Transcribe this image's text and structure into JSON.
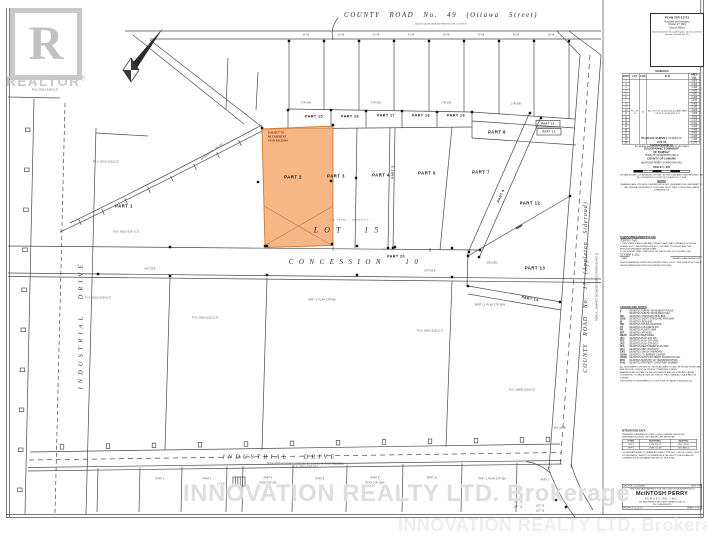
{
  "branding": {
    "logo_letter": "R",
    "logo_caption": "REALTOR",
    "logo_reg": "®",
    "watermark_text": "INNOVATION REALTY LTD.  Brokerage"
  },
  "deposit_box": {
    "plan_no": "PLAN 27R-11751",
    "received": "Received and Deposited",
    "date": "October 27, 2021",
    "signature": "Joanne Milner",
    "representative": "Representative for the Land Registrar for the Land Titles Division of Lanark (No. 27)"
  },
  "schedule": {
    "title": "SCHEDULE",
    "headers": [
      "PART",
      "LOT",
      "CON",
      "P.I.N.",
      "AREA (ha)"
    ],
    "lot": "PT. LOT 15",
    "con": "10",
    "pin": "ALL OF P.I.N. 05110-0114 (LT) AND PART OF P.I.N. 05110-0113 (LT)",
    "parts": [
      "1",
      "2",
      "3",
      "4",
      "5",
      "6",
      "7",
      "8",
      "9",
      "10",
      "11",
      "12",
      "13",
      "14",
      "15",
      "16",
      "17",
      "18",
      "19",
      "20"
    ],
    "areas": [
      "0.809",
      "0.405",
      "0.405",
      "0.405",
      "0.081",
      "0.405",
      "0.810",
      "0.405",
      "0.162",
      "0.008",
      "0.008",
      "1.620",
      "1.215",
      "0.243",
      "0.405",
      "0.405",
      "0.405",
      "0.405",
      "0.405",
      "0.073"
    ],
    "note": "ALL AREAS SHOWN ON THIS PLAN ARE IN HECTARES"
  },
  "title_block": {
    "t1a": "PLAN OF SURVEY",
    "t1b": "OF PART OF",
    "t2": "LOT 15",
    "t3": "CONCESSION 10",
    "t4": "GEOGRAPHIC TOWNSHIP\nOF RAMSAY",
    "t5": "TOWN OF MISSISSIPPI MILLS",
    "t6": "COUNTY OF LANARK",
    "firm": "McINTOSH PERRY SURVEYING INC.",
    "scale": "SCALE  1 : 800",
    "metric": "DISTANCES AND COORDINATES SHOWN ON THIS PLAN ARE IN METRES AND CAN BE CONVERTED TO FEET BY DIVIDING BY 0.3048",
    "notes_title": "NOTES",
    "notes_body": "BEARINGS ARE UTM GRID, DERIVED FROM GPS OBSERVATIONS, REFERRED TO THE CENTRAL MERIDIAN OF UTM ZONE 18 (75° WEST LONGITUDE), NAD83 (CSRS)(2010.0)"
  },
  "certificate": {
    "title": "SURVEYOR'S CERTIFICATE",
    "intro": "I CERTIFY THAT:",
    "c1": "1.  THIS SURVEY AND PLAN ARE CORRECT AND IN ACCORDANCE WITH THE SURVEYS ACT, THE SURVEYORS ACT, THE LAND TITLES ACT AND THE REGULATIONS MADE UNDER THEM.",
    "c2": "2.  THE SURVEY WAS COMPLETED ON THE 8th DAY OF OCTOBER, 2021.",
    "date": "OCTOBER 8, 2021",
    "date_cap": "DATE",
    "signer_cap": "ONTARIO LAND SURVEYOR",
    "note": "PLAN SUBMISSION FORM FILED UNDER O.REG. 216/10. THIS PLAN IS NOT VALID UNLESS EMBOSSED WITH THE SURVEYOR'S SEAL."
  },
  "legend": {
    "title": "LEGEND AND NOTES",
    "items": [
      [
        "■",
        "DENOTES SURVEY MONUMENT FOUND"
      ],
      [
        "□",
        "DENOTES SURVEY MONUMENT SET"
      ],
      [
        "SIB",
        "DENOTES STANDARD IRON BAR"
      ],
      [
        "SSIB",
        "DENOTES SHORT STANDARD IRON BAR"
      ],
      [
        "IB",
        "DENOTES IRON BAR"
      ],
      [
        "RIB",
        "DENOTES ROUND IRON BAR"
      ],
      [
        "CP",
        "DENOTES CONCRETE PIN"
      ],
      [
        "PB",
        "DENOTES PLASTIC BAR"
      ],
      [
        "WIT",
        "DENOTES WITNESS"
      ],
      [
        "MEAS",
        "DENOTES MEASURED"
      ],
      [
        "(P1)",
        "DENOTES PLAN 27R-306"
      ],
      [
        "(P2)",
        "DENOTES PLAN 27R-1606"
      ],
      [
        "(P3)",
        "DENOTES PLAN 27R-3421"
      ],
      [
        "(P4)",
        "DENOTES REGISTERED PLAN 6262"
      ],
      [
        "(D1)",
        "DENOTES INST. RS175478"
      ],
      [
        "(OU)",
        "DENOTES ORIGIN UNKNOWN"
      ],
      [
        "(1306)",
        "DENOTES J.D. BARNES LIMITED"
      ],
      [
        "(1606)",
        "DENOTES McINTOSH PERRY SURVEYING INC."
      ],
      [
        "MTO",
        "DENOTES MINISTRY OF TRANSPORTATION"
      ],
      [
        "P.I.N.",
        "DENOTES PROPERTY IDENTIFIER NUMBER"
      ]
    ],
    "footnotes": [
      "ALL MONUMENTS SHOWN ON THIS PLAN WERE FOUND OR SET AS NOTED AND ARE IN GOOD CONDITION UNLESS OTHERWISE STATED.",
      "BEARINGS AND DISTANCES SHOWN HEREON ARE GROUND AND CAN BE CONVERTED TO GRID BY MULTIPLYING BY THE COMBINED SCALE FACTOR 0.999890.",
      "THIS SURVEY IS INTEGRATED TO UTM ZONE 18, NAD83 (CSRS)(2010.0)."
    ]
  },
  "integration": {
    "title": "INTEGRATION DATA",
    "l1": "OBSERVED REFERENCE POINTS (ORPs) DERIVED FROM GPS OBSERVATION USING THE CAN-NET VRS NETWORK.",
    "headers": [
      "POINT",
      "NORTHING",
      "EASTING"
    ],
    "rows": [
      [
        "ORP 1",
        "4 998 476.11",
        "369 724.60"
      ],
      [
        "ORP 2",
        "4 998 212.48",
        "369 488.02"
      ]
    ],
    "l2": "COORDINATES ARE TO URBAN ACCURACY PER SEC. 14(2) OF O.REG. 216/10",
    "note": "COORDINATES CANNOT, IN THEMSELVES, BE USED TO RE-ESTABLISH CORNERS OR BOUNDARIES SHOWN ON THIS PLAN."
  },
  "firm_box": {
    "prep": "THIS PLAN WAS PREPARED FOR THE TOWN OF MISSISSIPPI MILLS",
    "name": "McINTOSH PERRY",
    "sub": "SURVEYING INC.",
    "addr1": "115 WALGREEN ROAD, CARP, ONTARIO  K0A 1L0",
    "addr2": "TEL: 1-888-348-8991",
    "job_l": "CAD FILE: 21-117-REG",
    "job_r": "DWG: 27R",
    "foot_l": "PROJECT: CL-21-117",
    "foot_r": "SHEET 1 OF 1"
  },
  "roads": {
    "top": "COUNTY   ROAD   No.  49   (Ottawa   Street)",
    "top_sub": "ROAD  ALLOWANCE  BETWEEN  LOTS  15  AND  16",
    "left": "INDUSTRIAL   DRIVE",
    "bottom": "INDUSTRIAL      DRIVE",
    "bottom_sub1": "DEDICATED AS PUBLIC ROAD BY BY-LAW 15-48, INST. RS188502",
    "bottom_sub2": "P.I.N. 05110-0297 (LT)",
    "right": "COUNTY  ROAD  No. 17  (Appleton  Sideroad)",
    "right_sub": "ROAD  ALLOWANCE  BETWEEN  CONCESSIONS  10  AND  11"
  },
  "labels": {
    "lot15": "LOT  15",
    "lot15_sub": "— J.W. STONE — KERNELLY —",
    "concession": "CONCESSION  10"
  },
  "parts": [
    {
      "t": "PART 1",
      "x": 124,
      "y": 206
    },
    {
      "t": "PART 2",
      "x": 293,
      "y": 177
    },
    {
      "t": "PART 3",
      "x": 336,
      "y": 176
    },
    {
      "t": "PART 4",
      "x": 381,
      "y": 175
    },
    {
      "t": "PART 5",
      "x": 393,
      "y": 172,
      "r": -90,
      "s": 6
    },
    {
      "t": "PART 6",
      "x": 427,
      "y": 173
    },
    {
      "t": "PART 7",
      "x": 481,
      "y": 172
    },
    {
      "t": "PART 8",
      "x": 497,
      "y": 132
    },
    {
      "t": "PART 9",
      "x": 501,
      "y": 196,
      "r": -66,
      "s": 6.5
    },
    {
      "t": "PART 10",
      "x": 548,
      "y": 123.5,
      "s": 5
    },
    {
      "t": "PART 11",
      "x": 549,
      "y": 131.5,
      "s": 5
    },
    {
      "t": "PART 12",
      "x": 530,
      "y": 203
    },
    {
      "t": "PART 13",
      "x": 535,
      "y": 268
    },
    {
      "t": "PART 14",
      "x": 530,
      "y": 299,
      "r": 10,
      "s": 7
    },
    {
      "t": "PART 15",
      "x": 314,
      "y": 116,
      "s": 7.4
    },
    {
      "t": "PART 16",
      "x": 350,
      "y": 116,
      "s": 7.4
    },
    {
      "t": "PART 17",
      "x": 386,
      "y": 115,
      "s": 7.4
    },
    {
      "t": "PART 18",
      "x": 421,
      "y": 115,
      "s": 7.4
    },
    {
      "t": "PART 19",
      "x": 456,
      "y": 115,
      "s": 7.4
    },
    {
      "t": "PART 20",
      "x": 396,
      "y": 256,
      "s": 7.4
    }
  ],
  "micro": [
    {
      "t": "30.48",
      "x": 306,
      "y": 35
    },
    {
      "t": "30.48",
      "x": 341,
      "y": 35
    },
    {
      "t": "30.48",
      "x": 376,
      "y": 35
    },
    {
      "t": "30.48",
      "x": 411,
      "y": 35
    },
    {
      "t": "30.48",
      "x": 446,
      "y": 35
    },
    {
      "t": "30.48",
      "x": 481,
      "y": 35
    },
    {
      "t": "30.48",
      "x": 516,
      "y": 35
    },
    {
      "t": "30.48",
      "x": 551,
      "y": 35
    },
    {
      "t": "27R-306",
      "x": 306,
      "y": 103
    },
    {
      "t": "27R-306",
      "x": 376,
      "y": 103
    },
    {
      "t": "27R-306",
      "x": 446,
      "y": 103
    },
    {
      "t": "27R-306",
      "x": 516,
      "y": 104
    },
    {
      "t": "P.I.N. 05110-0160 (LT)",
      "x": 45,
      "y": 90
    },
    {
      "t": "P.I.N. 05110-0113 (LT)",
      "x": 106,
      "y": 162
    },
    {
      "t": "P.I.N. 05110-0157 (LT)",
      "x": 126,
      "y": 232
    },
    {
      "t": "WIDENED BY 27R-306",
      "x": 212,
      "y": 152,
      "r": -37
    },
    {
      "t": "P.I.N. 05110-0154 (LT)",
      "x": 98,
      "y": 298
    },
    {
      "t": "P.I.N. 05110-0153 (LT)",
      "x": 205,
      "y": 318
    },
    {
      "t": "PART 3,  PLAN 27R-306",
      "x": 322,
      "y": 300
    },
    {
      "t": "P.I.N. 05110-0152 (LT)",
      "x": 430,
      "y": 331
    },
    {
      "t": "PART 12,  PLAN 27R-1606",
      "x": 490,
      "y": 305
    },
    {
      "t": "P.I.N. 05096-0318 (LT)",
      "x": 522,
      "y": 390
    },
    {
      "t": "N47°52'E",
      "x": 150,
      "y": 269
    },
    {
      "t": "N47°55'E",
      "x": 430,
      "y": 271
    },
    {
      "t": "SIB (306)",
      "x": 492,
      "y": 263
    },
    {
      "t": "SIB (1606)",
      "x": 560,
      "y": 428
    },
    {
      "t": "PART 2",
      "x": 160,
      "y": 479
    },
    {
      "t": "PART 3",
      "x": 207,
      "y": 479
    },
    {
      "t": "L I N K",
      "x": 221,
      "y": 484
    },
    {
      "t": "PART 4",
      "x": 268,
      "y": 478
    },
    {
      "t": "PLAN 27R-306",
      "x": 268,
      "y": 483
    },
    {
      "t": "PART 5",
      "x": 320,
      "y": 479
    },
    {
      "t": "PART 6",
      "x": 375,
      "y": 478
    },
    {
      "t": "PLAN 27R-1606",
      "x": 375,
      "y": 483
    },
    {
      "t": "PART 10",
      "x": 432,
      "y": 478
    },
    {
      "t": "PART 1,  PLAN 27R-306",
      "x": 492,
      "y": 479
    },
    {
      "t": "PART 1",
      "x": 545,
      "y": 480
    },
    {
      "t": "LOT 15",
      "x": 518,
      "y": 502
    },
    {
      "t": "LOT 16",
      "x": 518,
      "y": 507
    },
    {
      "t": "LOT 15",
      "x": 540,
      "y": 506
    },
    {
      "t": "LOT 16",
      "x": 540,
      "y": 511
    },
    {
      "t": "SUBJECT TO",
      "x": 276,
      "y": 133,
      "c": 1
    },
    {
      "t": "AN EASEMENT",
      "x": 277,
      "y": 137,
      "c": 1
    },
    {
      "t": "AS IN RS122648",
      "x": 278,
      "y": 141,
      "c": 1
    }
  ]
}
